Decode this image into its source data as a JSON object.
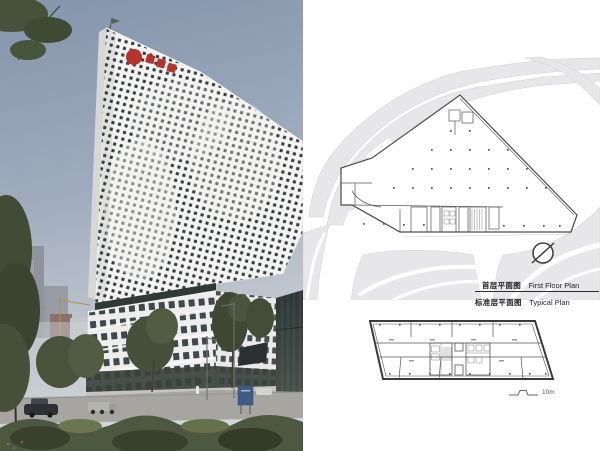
{
  "plans": {
    "first_floor": {
      "caption_zh": "首层平面图",
      "caption_en": "First Floor Plan"
    },
    "typical": {
      "caption_zh": "标准层平面图",
      "caption_en": "Typical Plan"
    },
    "scale_label": "10m"
  },
  "colors": {
    "logo_red": "#b5342c",
    "sky_top": "#8494ab",
    "sky_bottom": "#d4d7da",
    "site_gray": "#e7e7e9",
    "plan_line": "#4a4a4a",
    "foliage": "#4d5840"
  }
}
